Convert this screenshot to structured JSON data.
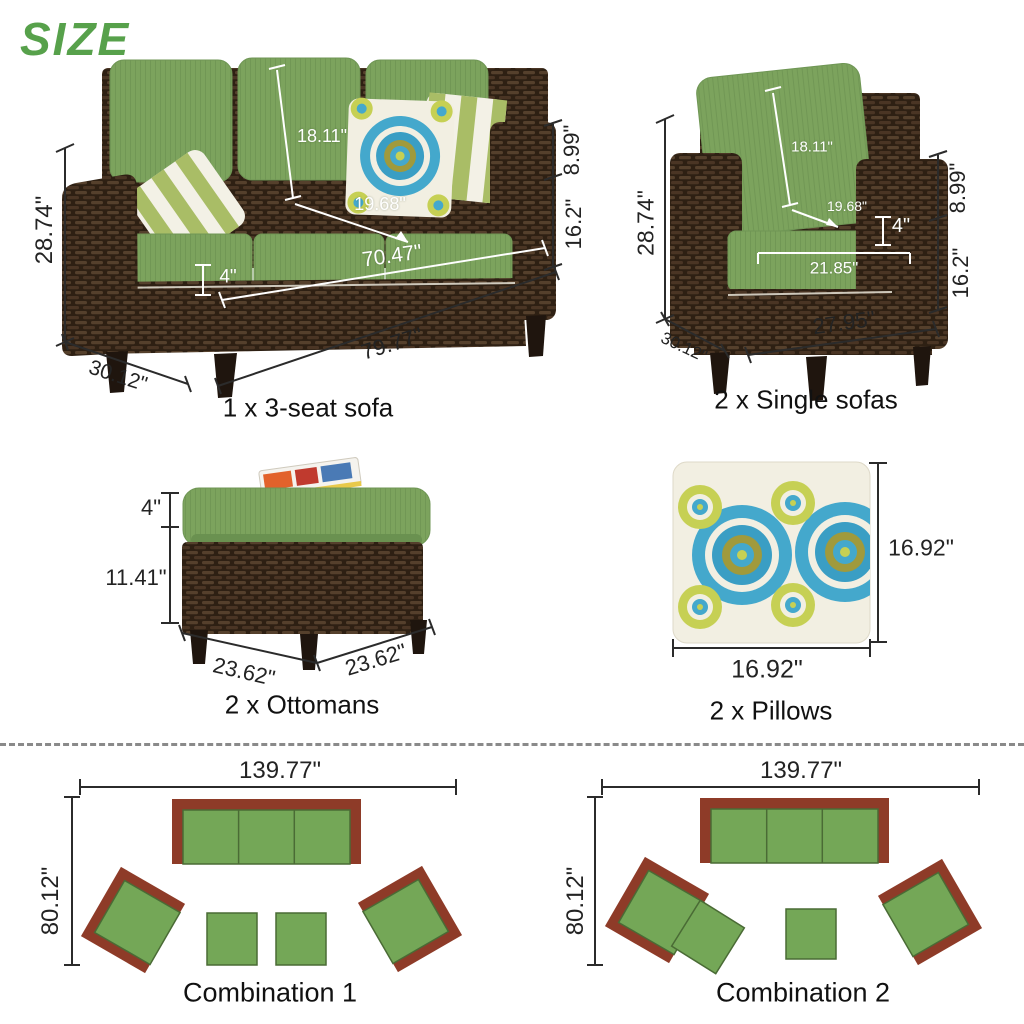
{
  "title": "SIZE",
  "colors": {
    "title_green": "#57a14b",
    "cushion_green": "#7ca35d",
    "wicker_brown": "#2e2013",
    "plan_border_red": "#8e3b28",
    "plan_seat_green": "#74a757",
    "pillow_teal": "#44a8cc",
    "pillow_lime": "#c6d054",
    "dimension_black": "#2b2b2b",
    "dimension_white": "#ffffff"
  },
  "products": {
    "sofa3": {
      "caption": "1 x 3-seat sofa",
      "dims": {
        "overall_height": "28.74\"",
        "back_cushion_height": "18.11\"",
        "seat_depth": "19.68\"",
        "cushion_thickness": "4\"",
        "inner_width": "70.47\"",
        "arm_above_seat": "8.99\"",
        "seat_height": "16.2\"",
        "overall_width": "79.77\"",
        "overall_depth": "30.12\""
      }
    },
    "single_sofa": {
      "caption": "2 x Single sofas",
      "dims": {
        "overall_height": "28.74\"",
        "back_cushion_height": "18.11\"",
        "seat_depth": "19.68\"",
        "cushion_thickness": "4\"",
        "inner_width": "21.85\"",
        "arm_above_seat": "8.99\"",
        "seat_height": "16.2\"",
        "overall_width": "27.95\"",
        "overall_depth": "30.12\""
      }
    },
    "ottoman": {
      "caption": "2 x Ottomans",
      "dims": {
        "cushion_thickness": "4\"",
        "base_height": "11.41\"",
        "width": "23.62\"",
        "depth": "23.62\""
      }
    },
    "pillow": {
      "caption": "2 x Pillows",
      "dims": {
        "height": "16.92\"",
        "width": "16.92\""
      }
    }
  },
  "combinations": {
    "c1": {
      "caption": "Combination 1",
      "overall_width": "139.77\"",
      "overall_depth": "80.12\""
    },
    "c2": {
      "caption": "Combination 2",
      "overall_width": "139.77\"",
      "overall_depth": "80.12\""
    }
  }
}
